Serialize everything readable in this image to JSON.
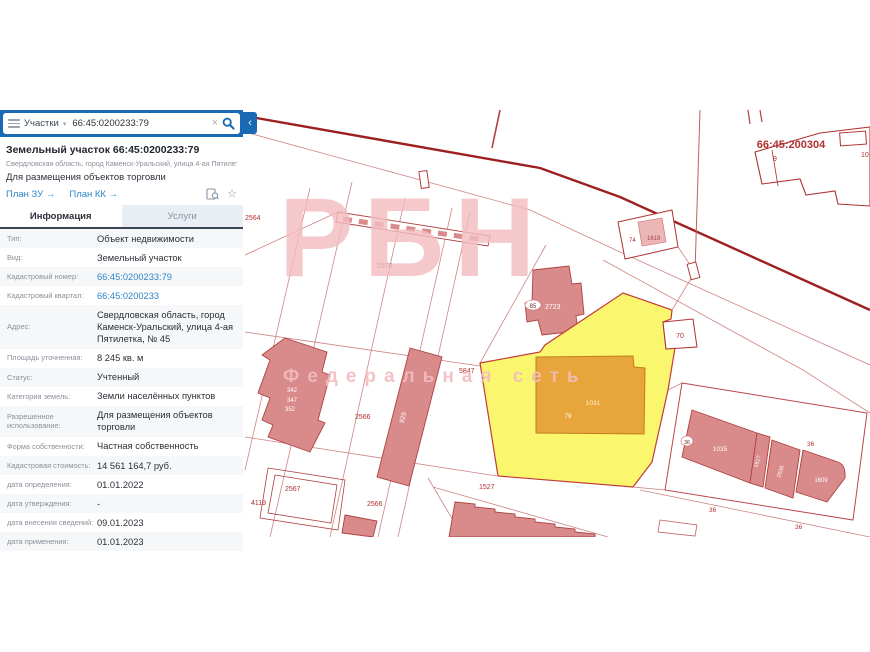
{
  "search": {
    "category": "Участки",
    "query": "66:45:0200233:79"
  },
  "icons": {
    "chevron_down": "▾",
    "clear": "×",
    "collapse": "‹",
    "star": "☆"
  },
  "result": {
    "title": "Земельный участок 66:45:0200233:79",
    "address": "Свердловская область, город Каменск-Уральский, улица 4-ая Пятилетка, № 45",
    "usage": "Для размещения объектов торговли",
    "plan_zu": "План ЗУ →",
    "plan_kk": "План КК →"
  },
  "tabs": {
    "info": "Информация",
    "services": "Услуги"
  },
  "details": {
    "rows": [
      {
        "label": "Тип:",
        "value": "Объект недвижимости"
      },
      {
        "label": "Вид:",
        "value": "Земельный участок"
      },
      {
        "label": "Кадастровый номер:",
        "value": "66:45:0200233:79"
      },
      {
        "label": "Кадастровый квартал:",
        "value": "66:45:0200233"
      },
      {
        "label": "Адрес:",
        "value": "Свердловская область, город Каменск-Уральский, улица 4-ая Пятилетка, № 45"
      },
      {
        "label": "Площадь уточненная:",
        "value": "8 245 кв. м"
      },
      {
        "label": "Статус:",
        "value": "Учтенный"
      },
      {
        "label": "Категория земель:",
        "value": "Земли населённых пунктов"
      },
      {
        "label": "Разрешенное использование:",
        "value": "Для размещения объектов торговли"
      },
      {
        "label": "Форма собственности:",
        "value": "Частная собственность"
      },
      {
        "label": "Кадастровая стоимость:",
        "value": "14 561 164,7 руб."
      },
      {
        "label": "дата определения:",
        "value": "01.01.2022"
      },
      {
        "label": "дата утверждения:",
        "value": "-"
      },
      {
        "label": "дата внесения сведений:",
        "value": "09.01.2023"
      },
      {
        "label": "дата применения:",
        "value": "01.01.2023"
      }
    ]
  },
  "map": {
    "watermark": {
      "title": "РБН",
      "subtitle": "Федеральная сеть"
    },
    "labels": {
      "quarter": "66:45:200304",
      "p9": "9",
      "p10": "10",
      "p74": "74",
      "b1618": "1618",
      "p70": "70",
      "p2570": "2570",
      "p2564": "2564",
      "p5847": "5847",
      "p2566a": "2566",
      "p2566b": "2566",
      "p2567": "2567",
      "p4119": "4119",
      "p1527": "1527",
      "b2723": "2723",
      "badge85": "85",
      "b342": "342",
      "b347": "347",
      "b352": "352",
      "b829": "829",
      "b1031": "1031",
      "badge79": "79",
      "b1035": "1035",
      "b1617": "1617",
      "b2636": "2636",
      "b1609": "1609",
      "badge36": "36",
      "p36a": "36",
      "p36b": "36",
      "p36c": "36"
    }
  },
  "colors": {
    "accent_blue": "#1a69b4",
    "link_blue": "#2e86c8",
    "map_red": "#b23434",
    "road_dark_red": "#9e1f1f",
    "selected_parcel_yellow": "#faf66e",
    "building_pink": "#dc9090",
    "building_orange": "#e8a53c",
    "watermark_pink": "#f3bcbf"
  }
}
